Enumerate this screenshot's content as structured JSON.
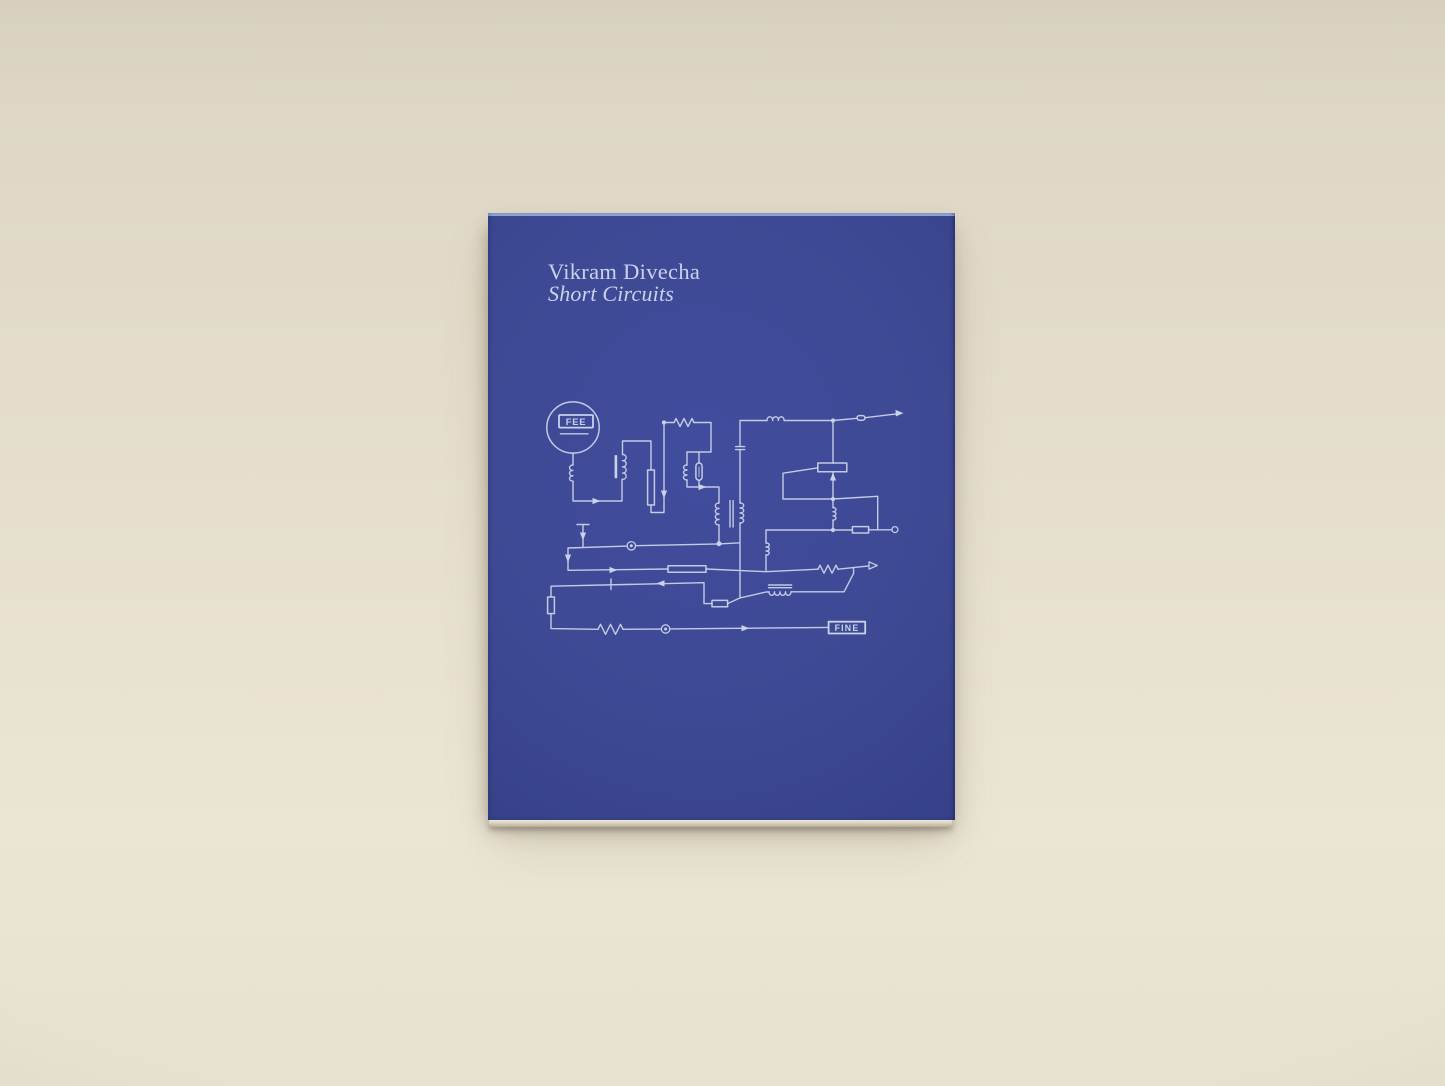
{
  "book": {
    "title": "Vikram Divecha",
    "subtitle": "Short Circuits",
    "circuit": {
      "start_label": "FEE",
      "end_label": "FINE"
    },
    "colors": {
      "background": "#e4ddcb",
      "cover": "#3d4993",
      "ink": "#cad1ea",
      "cover_edge_highlight": "#9db7e0",
      "page_edge": "#d9d2c0"
    }
  }
}
